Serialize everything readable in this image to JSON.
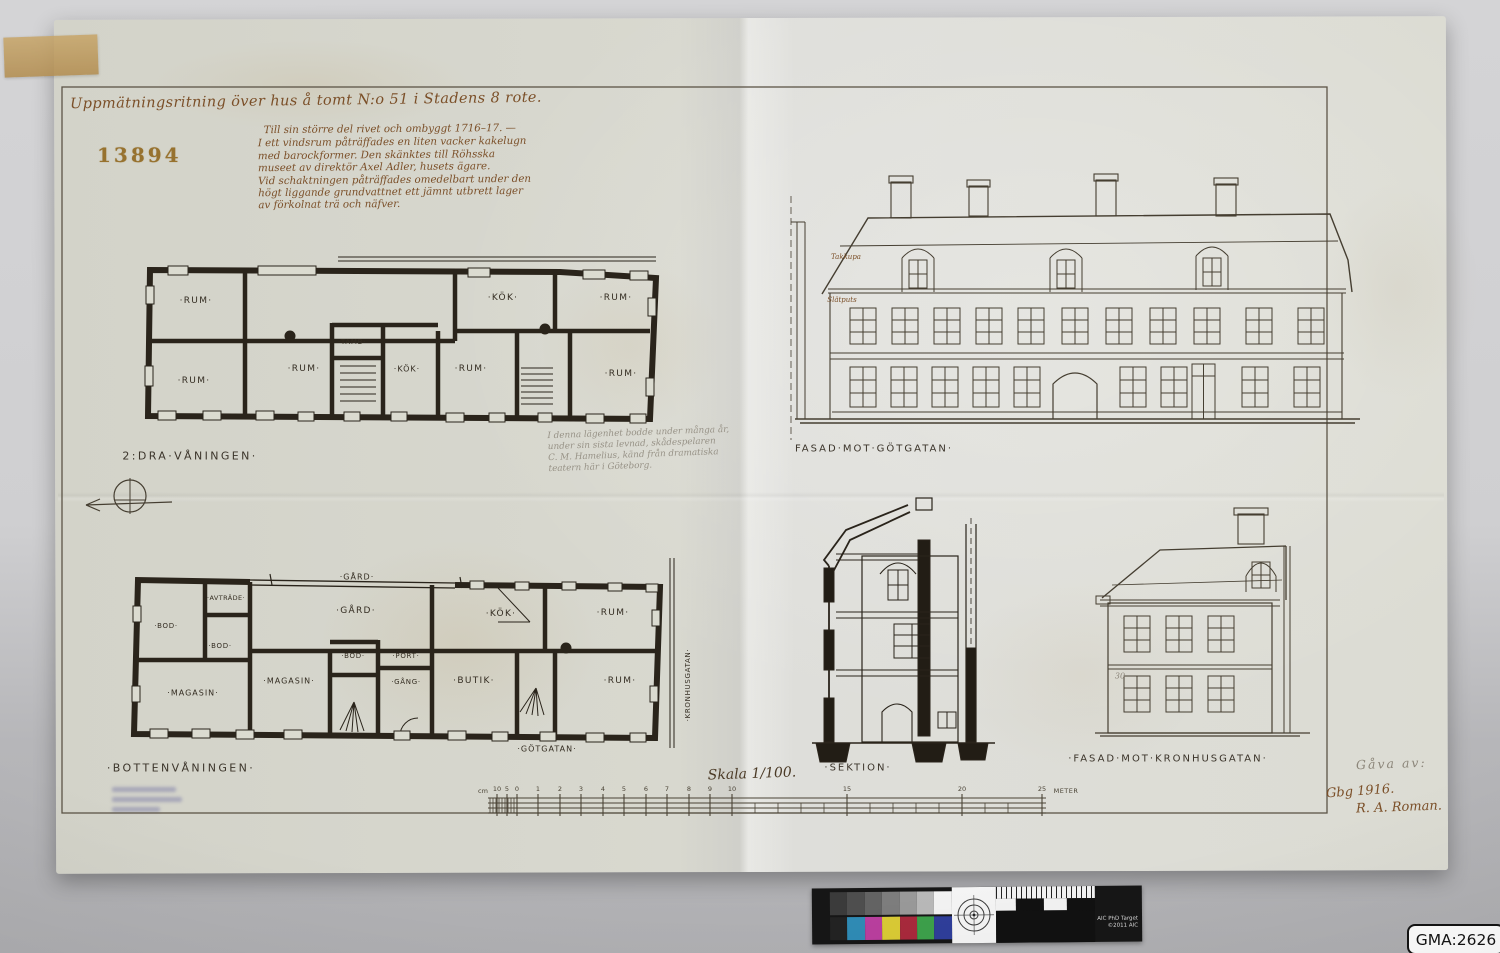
{
  "photo": {
    "archive_label": "GMA:2626",
    "calibration_target": {
      "label_line1": "AIC PhD Target",
      "label_line2": "©2011 AIC",
      "gray_patches": [
        "#3b3b3b",
        "#4e4e4e",
        "#636363",
        "#7d7d7d",
        "#999999",
        "#b8b8b8",
        "#f2f2f2"
      ],
      "color_patches": [
        "#222222",
        "#2f8bb5",
        "#b93f9e",
        "#d9ca35",
        "#a8293c",
        "#3da04b",
        "#2f3e9a"
      ]
    }
  },
  "sheet": {
    "stamp_number": "13894",
    "title": "Uppmätningsritning över hus å tomt N:o 51 i Stadens 8 rote.",
    "ink_note_lines": [
      "Till sin större del rivet och ombyggt 1716–17. —",
      "I ett vindsrum påträffades en liten vacker kakelugn",
      "med barockformer. Den skänktes till Röhsska",
      "museet av direktör Axel Adler, husets ägare.",
      "Vid schaktningen påträffades omedelbart under den",
      "högt liggande grundvattnet ett jämnt utbrett lager",
      "av förkolnat trä och näfver."
    ],
    "pencil_note_lines": [
      "I denna lägenhet bodde under många år,",
      "under sin sista levnad, skådespelaren",
      "C. M. Hamelius, känd från dramatiska",
      "teatern här i Göteborg."
    ],
    "plans": {
      "upper": {
        "caption": "2:DRA·VÅNINGEN·",
        "rooms": [
          "·RUM·",
          "·KÖK·",
          "·RUM·",
          "·RUM·",
          "·RUM·",
          "·TAMB·",
          "·KÖK·",
          "·RUM·",
          "·RUM·"
        ]
      },
      "ground": {
        "caption": "·BOTTENVÅNINGEN·",
        "rooms": [
          "·GÅRD·",
          "·AVTRÄDE·",
          "·BOD·",
          "·BOD·",
          "·GÅRD·",
          "·KÖK·",
          "·RUM·",
          "·MAGASIN·",
          "·MAGASIN·",
          "·BOD·",
          "·PORT·",
          "·GÅNG·",
          "·BUTIK·",
          "·RUM·"
        ],
        "street_right": "·KRONHUSGATAN·",
        "street_bottom": "·GÖTGATAN·"
      }
    },
    "elevations": {
      "gotgatan": {
        "caption": "FASAD·MOT·GÖTGATAN·",
        "annotation_roof": "Takkupa",
        "annotation_wall": "Slätputs"
      },
      "section": {
        "caption": "·SEKTION·"
      },
      "kronhusgatan": {
        "caption": "·FASAD·MOT·KRONHUSGATAN·",
        "annotation": "30"
      }
    },
    "scale": {
      "caption": "Skala 1/100.",
      "unit_left": "cm",
      "ticks": [
        "10",
        "5",
        "0",
        "1",
        "2",
        "3",
        "4",
        "5",
        "6",
        "7",
        "8",
        "9",
        "10",
        "15",
        "20",
        "25"
      ],
      "unit_right": "METER"
    },
    "signature": {
      "pencil": "Gåva av:",
      "place_year": "Gbg 1916.",
      "name": "R. A. Roman."
    }
  }
}
